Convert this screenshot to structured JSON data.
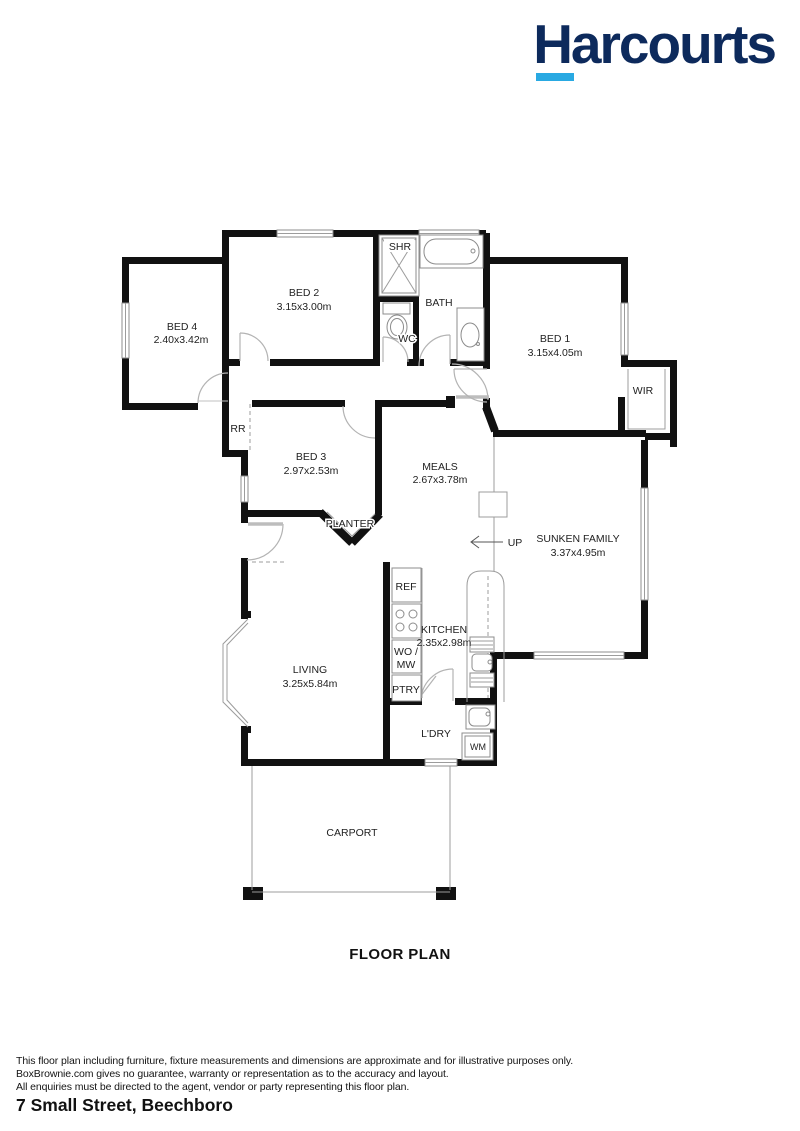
{
  "logo": {
    "brand": "Harcourts",
    "navy": "#0D2A5C",
    "blue": "#29A9E2"
  },
  "title": "FLOOR PLAN",
  "address": "7 Small Street, Beechboro",
  "disclaimer": {
    "line1": "This floor plan including furniture, fixture measurements and dimensions are approximate and for illustrative purposes only.",
    "line2": "BoxBrownie.com gives no guarantee, warranty or representation as to the accuracy and layout.",
    "line3": "All enquiries must be directed to the agent, vendor or party representing this floor plan."
  },
  "rooms": {
    "bed1": {
      "name": "BED 1",
      "dims": "3.15x4.05m"
    },
    "bed2": {
      "name": "BED 2",
      "dims": "3.15x3.00m"
    },
    "bed3": {
      "name": "BED 3",
      "dims": "2.97x2.53m"
    },
    "bed4": {
      "name": "BED 4",
      "dims": "2.40x3.42m"
    },
    "meals": {
      "name": "MEALS",
      "dims": "2.67x3.78m"
    },
    "family": {
      "name": "SUNKEN FAMILY",
      "dims": "3.37x4.95m"
    },
    "kitchen": {
      "name": "KITCHEN",
      "dims": "2.35x2.98m"
    },
    "living": {
      "name": "LIVING",
      "dims": "3.25x5.84m"
    },
    "laundry": {
      "name": "L'DRY"
    },
    "carport": {
      "name": "CARPORT"
    },
    "bath": {
      "name": "BATH"
    },
    "wc": {
      "name": "WC"
    },
    "shower": {
      "name": "SHR"
    },
    "wir": {
      "name": "WIR"
    },
    "rr": {
      "name": "RR"
    },
    "planter": {
      "name": "PLANTER"
    },
    "up": {
      "name": "UP"
    }
  },
  "fixtures": {
    "fridge": "REF",
    "oven_microwave_1": "WO /",
    "oven_microwave_2": "MW",
    "pantry": "PTRY",
    "washing_machine": "WM"
  }
}
